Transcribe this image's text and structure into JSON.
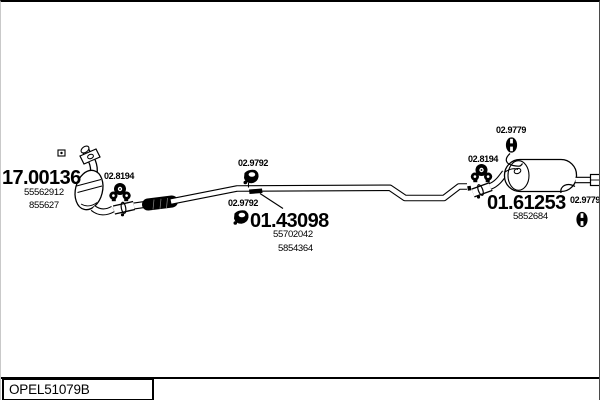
{
  "page": {
    "background": "#ffffff",
    "line_color": "#000000"
  },
  "footer": {
    "catalog_code": "OPEL51079B"
  },
  "parts": [
    {
      "name": "catalytic-converter",
      "code": "17.00136",
      "oe": [
        "55562912",
        "855627"
      ]
    },
    {
      "name": "centre-exhaust-pipe",
      "code": "01.43098",
      "oe": [
        "55702042",
        "5854364"
      ]
    },
    {
      "name": "rear-silencer",
      "code": "01.61253",
      "oe": [
        "5852684"
      ]
    }
  ],
  "fittings": [
    {
      "code": "02.8194",
      "icon": "clamp-icon",
      "location": "catalyst-outlet"
    },
    {
      "code": "02.9792",
      "icon": "rubber-hanger-icon",
      "location": "centre-pipe-upper"
    },
    {
      "code": "02.9792",
      "icon": "rubber-hanger-icon",
      "location": "centre-pipe-lower"
    },
    {
      "code": "02.8194",
      "icon": "clamp-icon",
      "location": "silencer-inlet"
    },
    {
      "code": "02.9779",
      "icon": "rubber-grommet-icon",
      "location": "silencer-front-mount"
    },
    {
      "code": "02.9779",
      "icon": "rubber-grommet-icon",
      "location": "silencer-rear-mount"
    }
  ]
}
